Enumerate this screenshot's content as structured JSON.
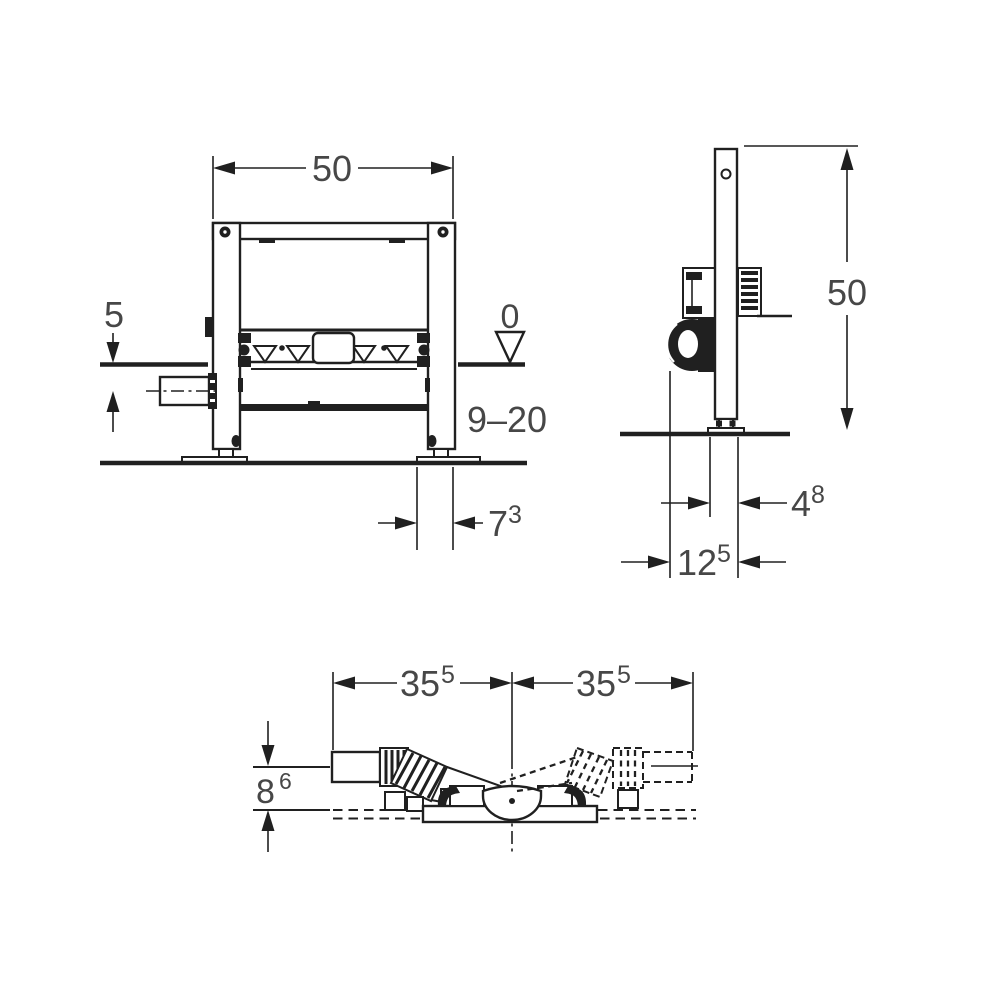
{
  "page": {
    "background": "#ffffff"
  },
  "colors": {
    "line": "#202020",
    "text": "#474747",
    "fill": "#ffffff"
  },
  "front_view": {
    "width_label": "50",
    "floor_offset_label": "5",
    "datum_zero_label": "0",
    "depth_range_label": "9–20",
    "foot_offset_main": "7",
    "foot_offset_sup": "3"
  },
  "side_view": {
    "height_label": "50",
    "rail_depth_main": "4",
    "rail_depth_sup": "8",
    "outlet_offset_main": "12",
    "outlet_offset_sup": "5"
  },
  "plan_view": {
    "left_half_main": "35",
    "left_half_sup": "5",
    "right_half_main": "35",
    "right_half_sup": "5",
    "axis_offset_main": "8",
    "axis_offset_sup": "6"
  }
}
